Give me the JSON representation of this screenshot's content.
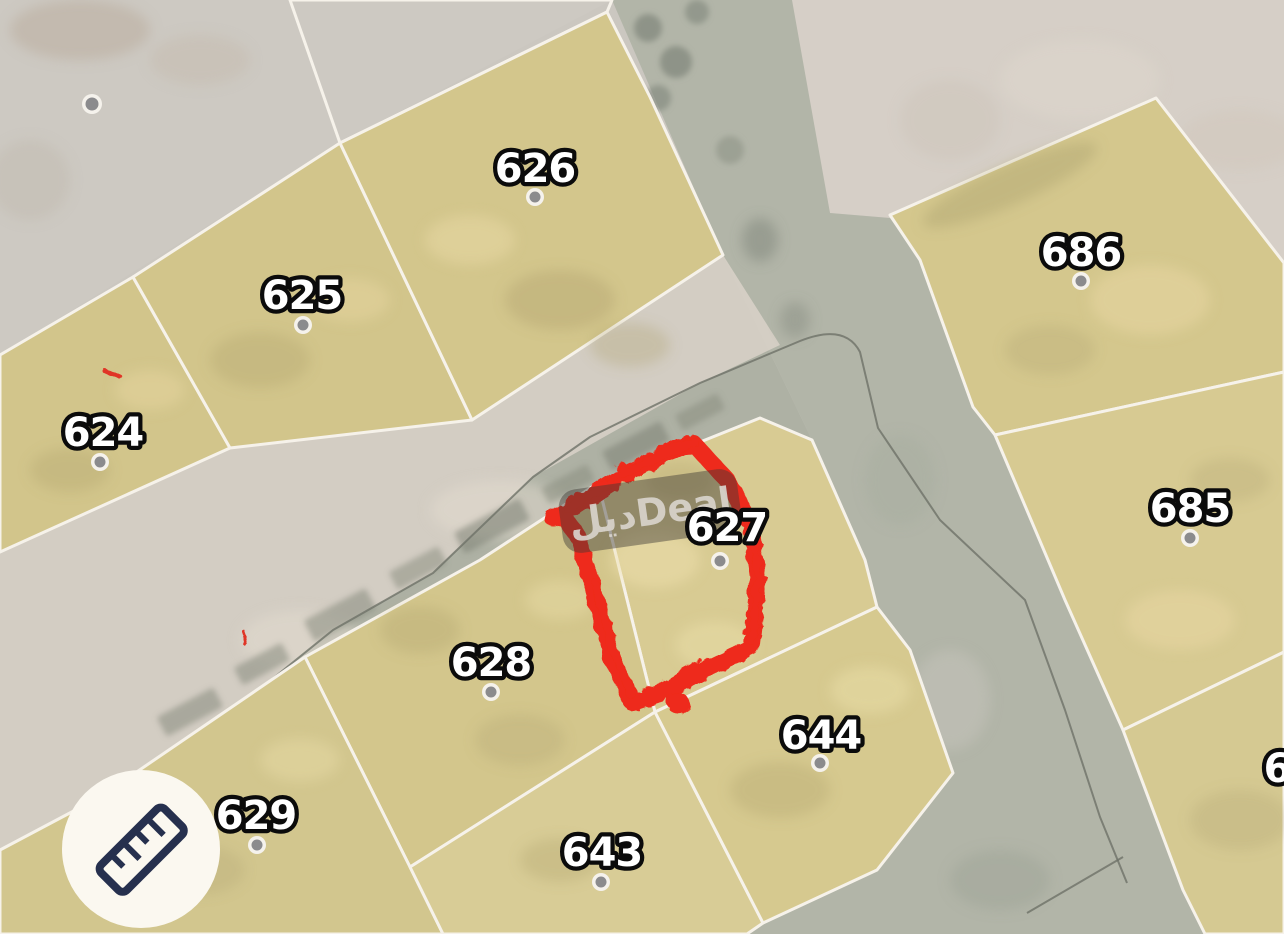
{
  "app": {
    "view": "cadastral-parcel-map"
  },
  "map": {
    "watermark_text": "ديلDeal",
    "highlighted_parcel": "627",
    "highlight_color": "#ee2a1a",
    "parcel_labels": [
      {
        "number": "624",
        "x": 103,
        "y": 432,
        "dot_x": 100,
        "dot_y": 462
      },
      {
        "number": "625",
        "x": 302,
        "y": 295,
        "dot_x": 303,
        "dot_y": 325
      },
      {
        "number": "626",
        "x": 535,
        "y": 168,
        "dot_x": 535,
        "dot_y": 197
      },
      {
        "number": "627",
        "x": 727,
        "y": 527,
        "dot_x": 720,
        "dot_y": 561
      },
      {
        "number": "628",
        "x": 491,
        "y": 662,
        "dot_x": 491,
        "dot_y": 692
      },
      {
        "number": "629",
        "x": 256,
        "y": 815,
        "dot_x": 257,
        "dot_y": 845
      },
      {
        "number": "643",
        "x": 602,
        "y": 852,
        "dot_x": 601,
        "dot_y": 882
      },
      {
        "number": "644",
        "x": 821,
        "y": 735,
        "dot_x": 820,
        "dot_y": 763
      },
      {
        "number": "685",
        "x": 1190,
        "y": 508,
        "dot_x": 1190,
        "dot_y": 538
      },
      {
        "number": "686",
        "x": 1081,
        "y": 252,
        "dot_x": 1081,
        "dot_y": 281
      },
      {
        "number": "6",
        "x": 1277,
        "y": 768,
        "partial": true
      }
    ],
    "unlabeled_marker": {
      "x": 92,
      "y": 104
    }
  },
  "controls": {
    "measure_button_icon": "ruler"
  },
  "colors": {
    "background": "#cbc7c0",
    "unzoned_east": "#d6cfc7",
    "road": "#b2b5a8",
    "building_strip": "#d7d0c6",
    "parcel_fill": "#d4c78e",
    "parcel_border": "#f6f2ea",
    "label_fill": "#ffffff",
    "label_outline": "#0b0b0b",
    "watermark_bg": "#3f3a35",
    "measure_icon": "#26304e",
    "measure_button_bg": "#fbf8f0"
  }
}
